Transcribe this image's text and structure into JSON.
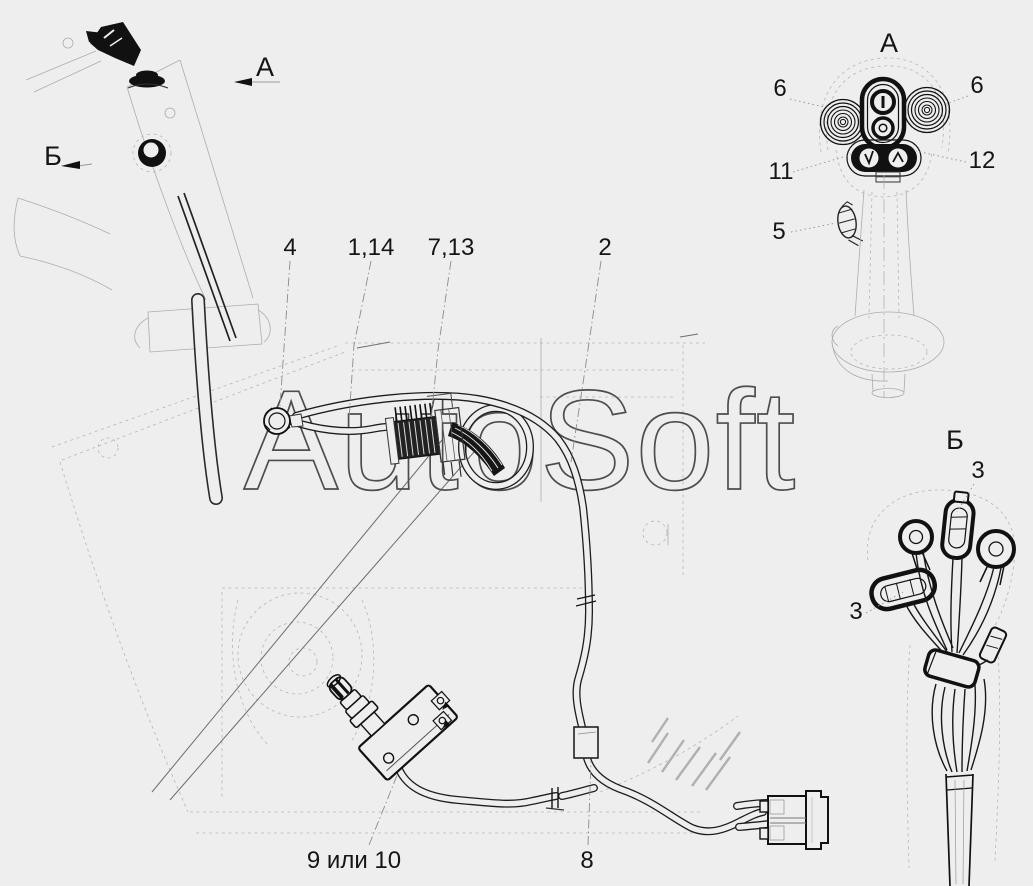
{
  "background_color": "#eeeeee",
  "watermark": {
    "text": "AutoSoft",
    "outline_color": "#4d4d4d"
  },
  "views": {
    "main": {
      "arrow_a_label": "А",
      "arrow_b_label": "Б"
    },
    "detail_a": {
      "title": "А"
    },
    "detail_b": {
      "title": "Б"
    }
  },
  "callouts": {
    "c4": "4",
    "c1_14": "1,14",
    "c7_13": "7,13",
    "c2": "2",
    "c9_or_10": "9 или 10",
    "c8": "8",
    "c6_left": "6",
    "c6_right": "6",
    "c11": "11",
    "c12": "12",
    "c5": "5",
    "c3_top": "3",
    "c3_side": "3"
  }
}
